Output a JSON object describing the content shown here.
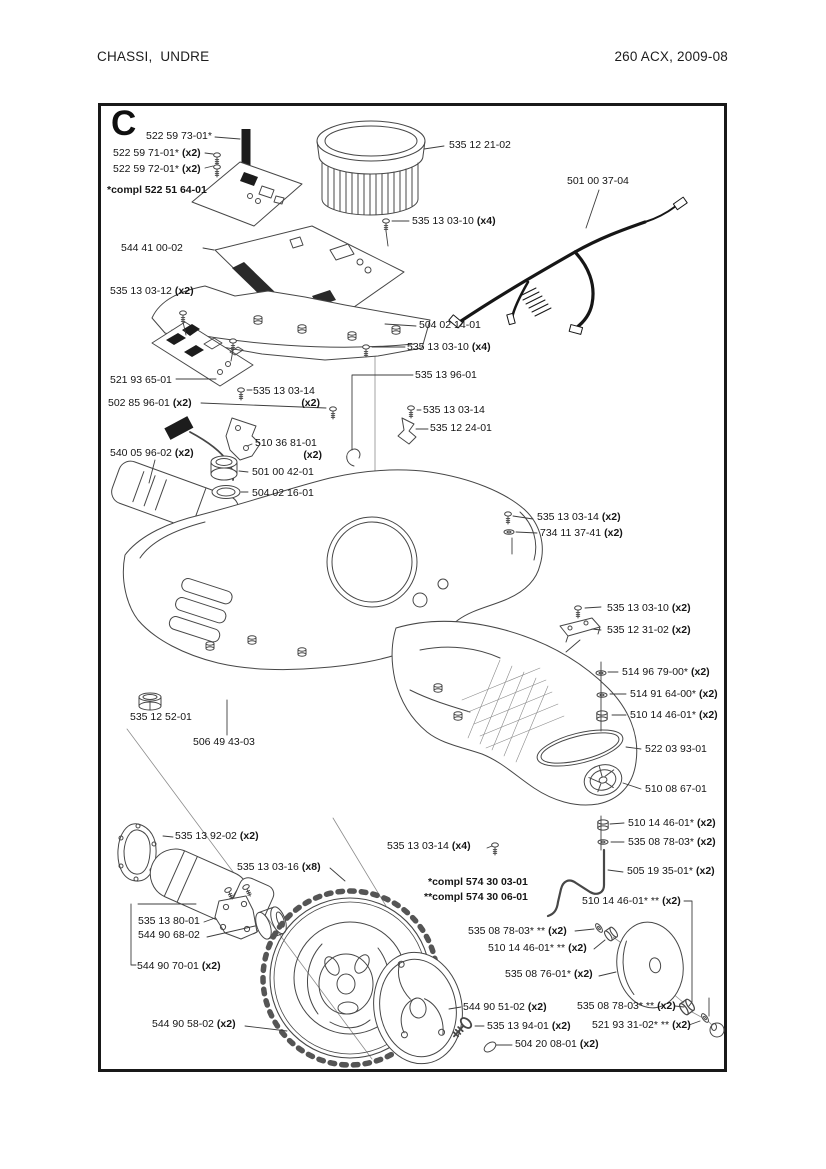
{
  "header": {
    "left": "CHASSI,  UNDRE",
    "right": "260 ACX, 2009-08"
  },
  "diagram": {
    "section_letter": "C",
    "line_color": "#474747",
    "labels": [
      {
        "num": "522 59 73-01*",
        "qty": ""
      },
      {
        "num": "522 59 71-01*",
        "qty": "(x2)"
      },
      {
        "num": "522 59 72-01*",
        "qty": "(x2)"
      },
      {
        "num": "*compl 522 51 64-01",
        "qty": ""
      },
      {
        "num": "544 41 00-02",
        "qty": ""
      },
      {
        "num": "535 13 03-12",
        "qty": "(x2)"
      },
      {
        "num": "521 93 65-01",
        "qty": ""
      },
      {
        "num": "502 85 96-01",
        "qty": "(x2)"
      },
      {
        "num": "540 05 96-02",
        "qty": "(x2)"
      },
      {
        "num": "535 12 21-02",
        "qty": ""
      },
      {
        "num": "535 13 03-10",
        "qty": "(x4)"
      },
      {
        "num": "501 00 37-04",
        "qty": ""
      },
      {
        "num": "504 02 14-01",
        "qty": ""
      },
      {
        "num": "535 13 03-10",
        "qty": "(x4)"
      },
      {
        "num": "535 13 96-01",
        "qty": ""
      },
      {
        "num": "535 13 03-14",
        "qty": ""
      },
      {
        "num": "535 12 24-01",
        "qty": ""
      },
      {
        "num": "535 13 03-14",
        "qty": "(x2)"
      },
      {
        "num": "510 36 81-01",
        "qty": "(x2)"
      },
      {
        "num": "501 00 42-01",
        "qty": ""
      },
      {
        "num": "504 02 16-01",
        "qty": ""
      },
      {
        "num": "535 13 03-14",
        "qty": "(x2)"
      },
      {
        "num": "734 11 37-41",
        "qty": "(x2)"
      },
      {
        "num": "535 13 03-10",
        "qty": "(x2)"
      },
      {
        "num": "535 12 31-02",
        "qty": "(x2)"
      },
      {
        "num": "514 96 79-00*",
        "qty": "(x2)"
      },
      {
        "num": "514 91 64-00*",
        "qty": "(x2)"
      },
      {
        "num": "510 14 46-01*",
        "qty": "(x2)"
      },
      {
        "num": "522 03 93-01",
        "qty": ""
      },
      {
        "num": "510 08 67-01",
        "qty": ""
      },
      {
        "num": "510 14 46-01*",
        "qty": "(x2)"
      },
      {
        "num": "535 08 78-03*",
        "qty": "(x2)"
      },
      {
        "num": "505 19 35-01*",
        "qty": "(x2)"
      },
      {
        "num": "535 12 52-01",
        "qty": ""
      },
      {
        "num": "506 49 43-03",
        "qty": ""
      },
      {
        "num": "535 13 92-02",
        "qty": "(x2)"
      },
      {
        "num": "535 13 03-16",
        "qty": "(x8)"
      },
      {
        "num": "535 13 03-14",
        "qty": "(x4)"
      },
      {
        "num": "*compl 574 30 03-01",
        "qty": ""
      },
      {
        "num": "**compl 574 30 06-01",
        "qty": ""
      },
      {
        "num": "510 14 46-01* **",
        "qty": "(x2)"
      },
      {
        "num": "535 08 78-03* **",
        "qty": "(x2)"
      },
      {
        "num": "510 14 46-01* **",
        "qty": "(x2)"
      },
      {
        "num": "535 08 76-01*",
        "qty": "(x2)"
      },
      {
        "num": "535 08 78-03* **",
        "qty": "(x2)"
      },
      {
        "num": "521 93 31-02* **",
        "qty": "(x2)"
      },
      {
        "num": "535 13 80-01",
        "qty": ""
      },
      {
        "num": "544 90 68-02",
        "qty": ""
      },
      {
        "num": "544 90 70-01",
        "qty": "(x2)"
      },
      {
        "num": "544 90 58-02",
        "qty": "(x2)"
      },
      {
        "num": "544 90 51-02",
        "qty": "(x2)"
      },
      {
        "num": "535 13 94-01",
        "qty": "(x2)"
      },
      {
        "num": "504 20 08-01",
        "qty": "(x2)"
      }
    ]
  }
}
